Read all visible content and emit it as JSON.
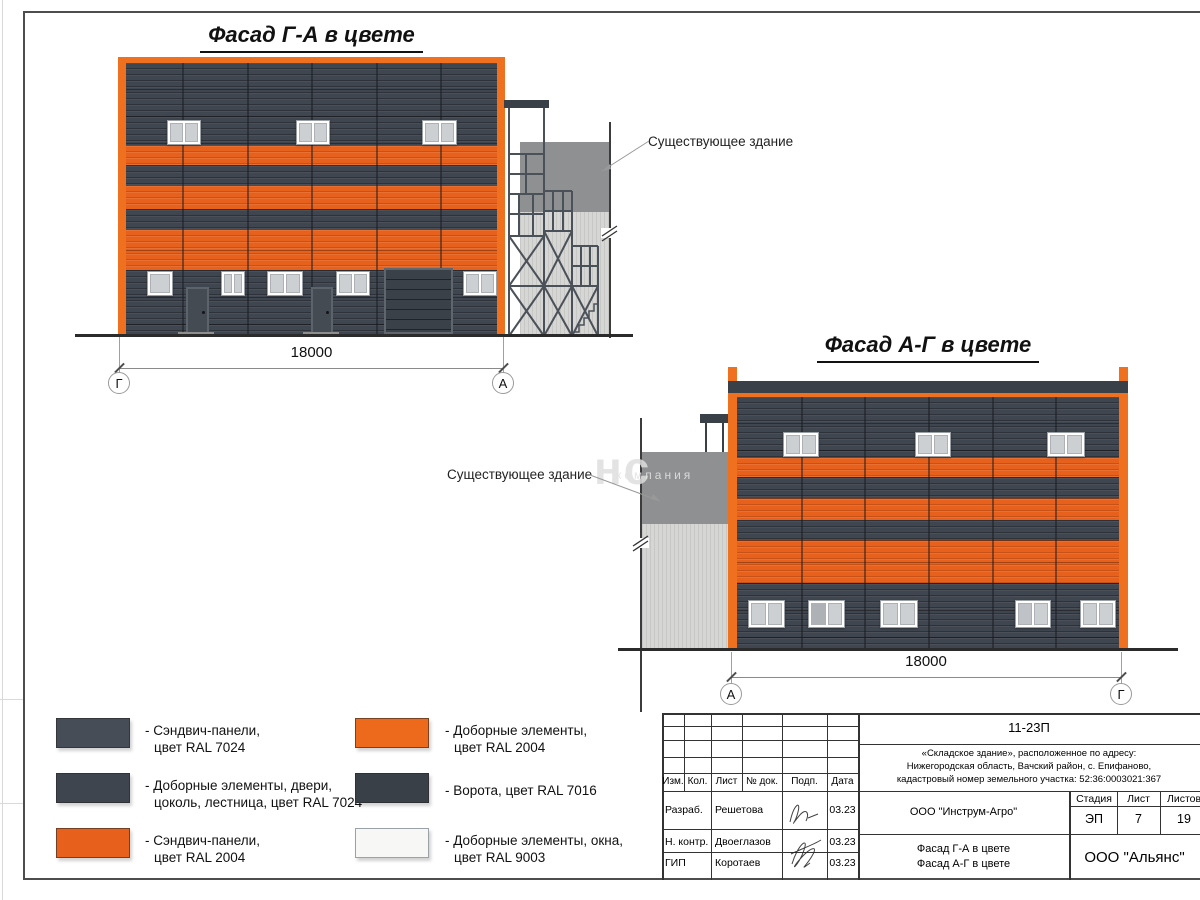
{
  "facade_ga": {
    "title": "Фасад Г-А в цвете",
    "dimension": "18000",
    "axis_left": "Г",
    "axis_right": "А",
    "existing_building_label": "Существующее здание"
  },
  "facade_ag": {
    "title": "Фасад А-Г в цвете",
    "dimension": "18000",
    "axis_left": "А",
    "axis_right": "Г",
    "existing_building_label": "Существующее здание"
  },
  "watermark": {
    "big": "нс",
    "small": "компания"
  },
  "legend": {
    "items": [
      {
        "swatch_color": "#474D56",
        "line1": "- Сэндвич-панели,",
        "line2": "цвет RAL 7024"
      },
      {
        "swatch_color": "#3F454E",
        "line1": "- Доборные элементы, двери,",
        "line2": "цоколь, лестница, цвет RAL 7024"
      },
      {
        "swatch_color": "#E8611C",
        "line1": "- Сэндвич-панели,",
        "line2": "цвет RAL 2004"
      },
      {
        "swatch_color": "#ED6A1C",
        "line1": "- Доборные элементы,",
        "line2": "цвет RAL 2004"
      },
      {
        "swatch_color": "#394048",
        "line1": "- Ворота, цвет RAL 7016",
        "line2": ""
      },
      {
        "swatch_color": "#F7F8F5",
        "line1": "- Доборные элементы, окна,",
        "line2": "цвет RAL 9003"
      }
    ]
  },
  "title_block": {
    "doc_number": "11-23П",
    "address_line1": "«Складское здание», расположенное по адресу:",
    "address_line2": "Нижегородская область, Вачский район, с. Епифаново,",
    "address_line3": "кадастровый номер земельного участка: 52:36:0003021:367",
    "col_izm": "Изм.",
    "col_kol": "Кол.",
    "col_list": "Лист",
    "col_doc": "№ док.",
    "col_podp": "Подп.",
    "col_data": "Дата",
    "row1_role": "Разраб.",
    "row1_name": "Решетова",
    "row1_date": "03.23",
    "row2_role": "Н. контр.",
    "row2_name": "Двоеглазов",
    "row2_date": "03.23",
    "row3_role": "ГИП",
    "row3_name": "Коротаев",
    "row3_date": "03.23",
    "designer_org": "ООО \"Инструм-Агро\"",
    "sheet_name_line1": "Фасад Г-А в цвете",
    "sheet_name_line2": "Фасад А-Г в цвете",
    "stage_label": "Стадия",
    "sheet_label": "Лист",
    "sheets_label": "Листов",
    "stage_value": "ЭП",
    "sheet_value": "7",
    "sheets_value": "19",
    "org": "ООО \"Альянс\""
  },
  "colors": {
    "panel_dark_ral7024": "#41474F",
    "trim_dark_ral7024": "#3F454E",
    "panel_orange_ral2004": "#E8611C",
    "trim_orange_ral2004": "#ED6A1C",
    "gate_ral7016": "#394048",
    "window_ral9003": "#F7F8F5",
    "existing_dark": "#8F9092",
    "existing_light": "#D6D6D4"
  }
}
